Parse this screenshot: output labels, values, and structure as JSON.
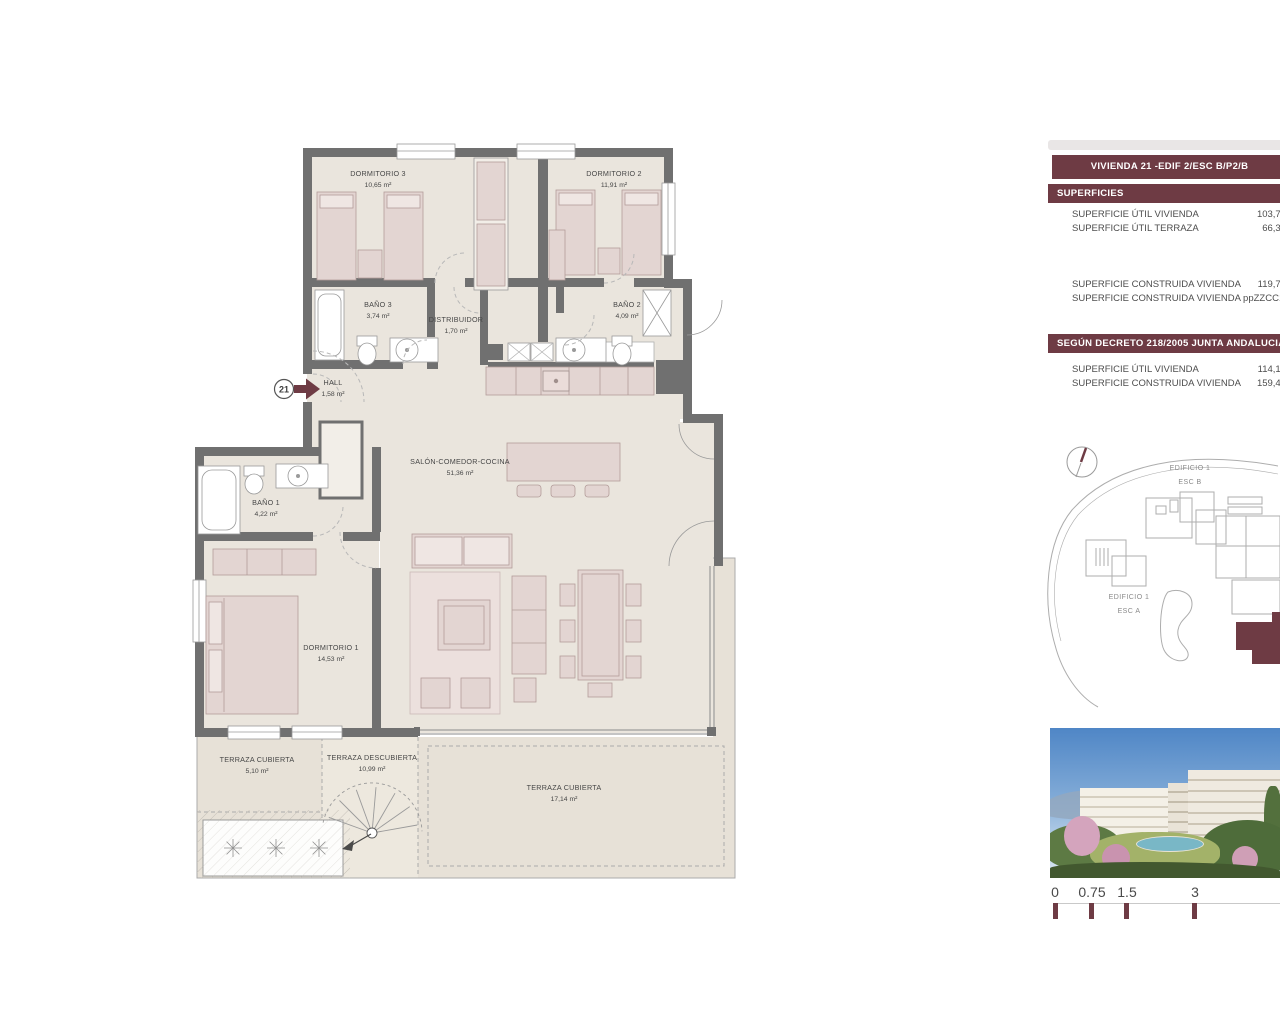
{
  "colors": {
    "accent": "#6E3B44",
    "wall": "#707070",
    "floor": "#EAE5DD",
    "terrace": "#E7E1D7",
    "furniture": "#E3D5D2"
  },
  "panel": {
    "title": "VIVIENDA 21 -EDIF 2/ESC B/P2/B",
    "superficies": {
      "header": "SUPERFICIES",
      "rows_utiles": [
        {
          "label": "SUPERFICIE ÚTIL VIVIENDA",
          "value": "103,78"
        },
        {
          "label": "SUPERFICIE ÚTIL TERRAZA",
          "value": "66,36"
        }
      ],
      "rows_construidas": [
        {
          "label": "SUPERFICIE CONSTRUIDA VIVIENDA",
          "value": "119,74"
        },
        {
          "label": "SUPERFICIE CONSTRUIDA VIVIENDA ppZZCC",
          "value": "149,10"
        }
      ]
    },
    "decreto": {
      "header": "SEGÚN DECRETO 218/2005 JUNTA ANDALUCIA",
      "rows": [
        {
          "label": "SUPERFICIE ÚTIL VIVIENDA",
          "value": "114,16"
        },
        {
          "label": "SUPERFICIE CONSTRUIDA VIVIENDA",
          "value": "159,48"
        }
      ]
    }
  },
  "floorplan": {
    "entrance_number": "21",
    "rooms": [
      {
        "name": "DORMITORIO 3",
        "area": "10,65 m²"
      },
      {
        "name": "DORMITORIO 2",
        "area": "11,91 m²"
      },
      {
        "name": "BAÑO 3",
        "area": "3,74 m²"
      },
      {
        "name": "DISTRIBUIDOR",
        "area": "1,70 m²"
      },
      {
        "name": "BAÑO 2",
        "area": "4,09 m²"
      },
      {
        "name": "HALL",
        "area": "1,58 m²"
      },
      {
        "name": "SALÓN-COMEDOR-COCINA",
        "area": "51,36 m²"
      },
      {
        "name": "BAÑO 1",
        "area": "4,22 m²"
      },
      {
        "name": "DORMITORIO 1",
        "area": "14,53 m²"
      },
      {
        "name": "TERRAZA CUBIERTA",
        "area": "5,10 m²"
      },
      {
        "name": "TERRAZA DESCUBIERTA",
        "area": "10,99 m²"
      },
      {
        "name": "TERRAZA CUBIERTA",
        "area": "17,14 m²"
      }
    ]
  },
  "siteplan": {
    "edificio1_top": "EDIFICIO 1",
    "esc_b": "ESC B",
    "edificio1_left": "EDIFICIO 1",
    "esc_a": "ESC A"
  },
  "scalebar": {
    "ticks": [
      "0",
      "0.75",
      "1.5",
      "3"
    ]
  }
}
